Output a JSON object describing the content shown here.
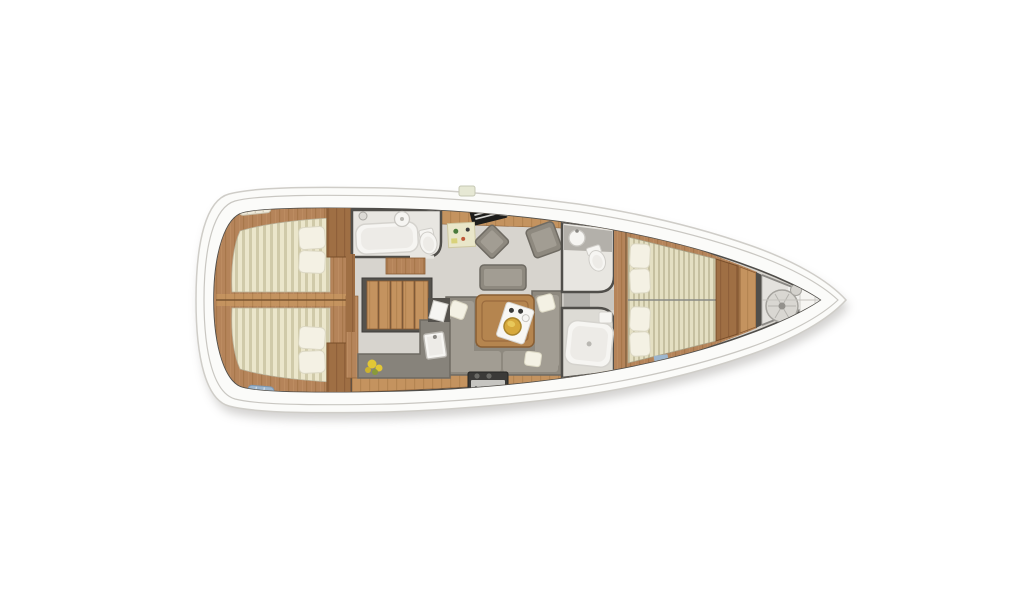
{
  "image": {
    "background": "#ffffff"
  },
  "palette": {
    "hull": "#fbfbf9",
    "hullStroke": "#cfcdc8",
    "deckLine": "#c9c7c2",
    "shadow": "#9c9a96",
    "wall": "#504e4a",
    "floorMid": "#d7d4ce",
    "floorHead": "#e8e6e1",
    "floorHeadLower": "#dddbd5",
    "floorCorridor": "#c9c6c0",
    "bowFloor": "#e4e2de",
    "bowFloorLight": "#f0efec",
    "wood": "#b5845a",
    "woodLight": "#c4935f",
    "woodDark": "#9f6f44",
    "woodLine": "#8a5c33",
    "stairWell": "#55524d",
    "mattressLight": "#ebe6cb",
    "mattressDark": "#d0caa9",
    "mattressFwdLight": "#e4dfc2",
    "mattressFwdDark": "#c6c0a0",
    "pillow": "#f4f1e4",
    "sofa": "#8e897f",
    "sofaLight": "#a29d93",
    "sofaDark": "#6f6b63",
    "counter": "#87837b",
    "counterTop": "#b3b0aa",
    "fixtureWhite": "#f6f5f2",
    "fixtureInner": "#edebe7",
    "fixtureStroke": "#cfcdc8",
    "chartBlack": "#1d1d1b",
    "paperWhite": "#f8f7f4",
    "mapPaper": "#e9e6c9",
    "tableWood": "#b5854f",
    "tableInner": "#c9965e",
    "bowlGold": "#d7a93c",
    "flowerYellow": "#e3c735",
    "flowerOlive": "#8a9a3a",
    "accentBlue": "#9db6ce",
    "hatchCream": "#efeadb",
    "metal": "#c6c5c1",
    "stoveDark": "#3b3a38",
    "windlass": "#d9d7d2",
    "windlassStroke": "#a5a39e",
    "seam": "#8a8a84"
  },
  "regions": [
    {
      "name": "aft-cabin-port"
    },
    {
      "name": "aft-cabin-starboard"
    },
    {
      "name": "aft-head"
    },
    {
      "name": "companionway-stairs"
    },
    {
      "name": "nav-station"
    },
    {
      "name": "salon"
    },
    {
      "name": "galley"
    },
    {
      "name": "forward-head-upper"
    },
    {
      "name": "forward-head-lower"
    },
    {
      "name": "owners-cabin-forward"
    },
    {
      "name": "bow-locker"
    }
  ]
}
